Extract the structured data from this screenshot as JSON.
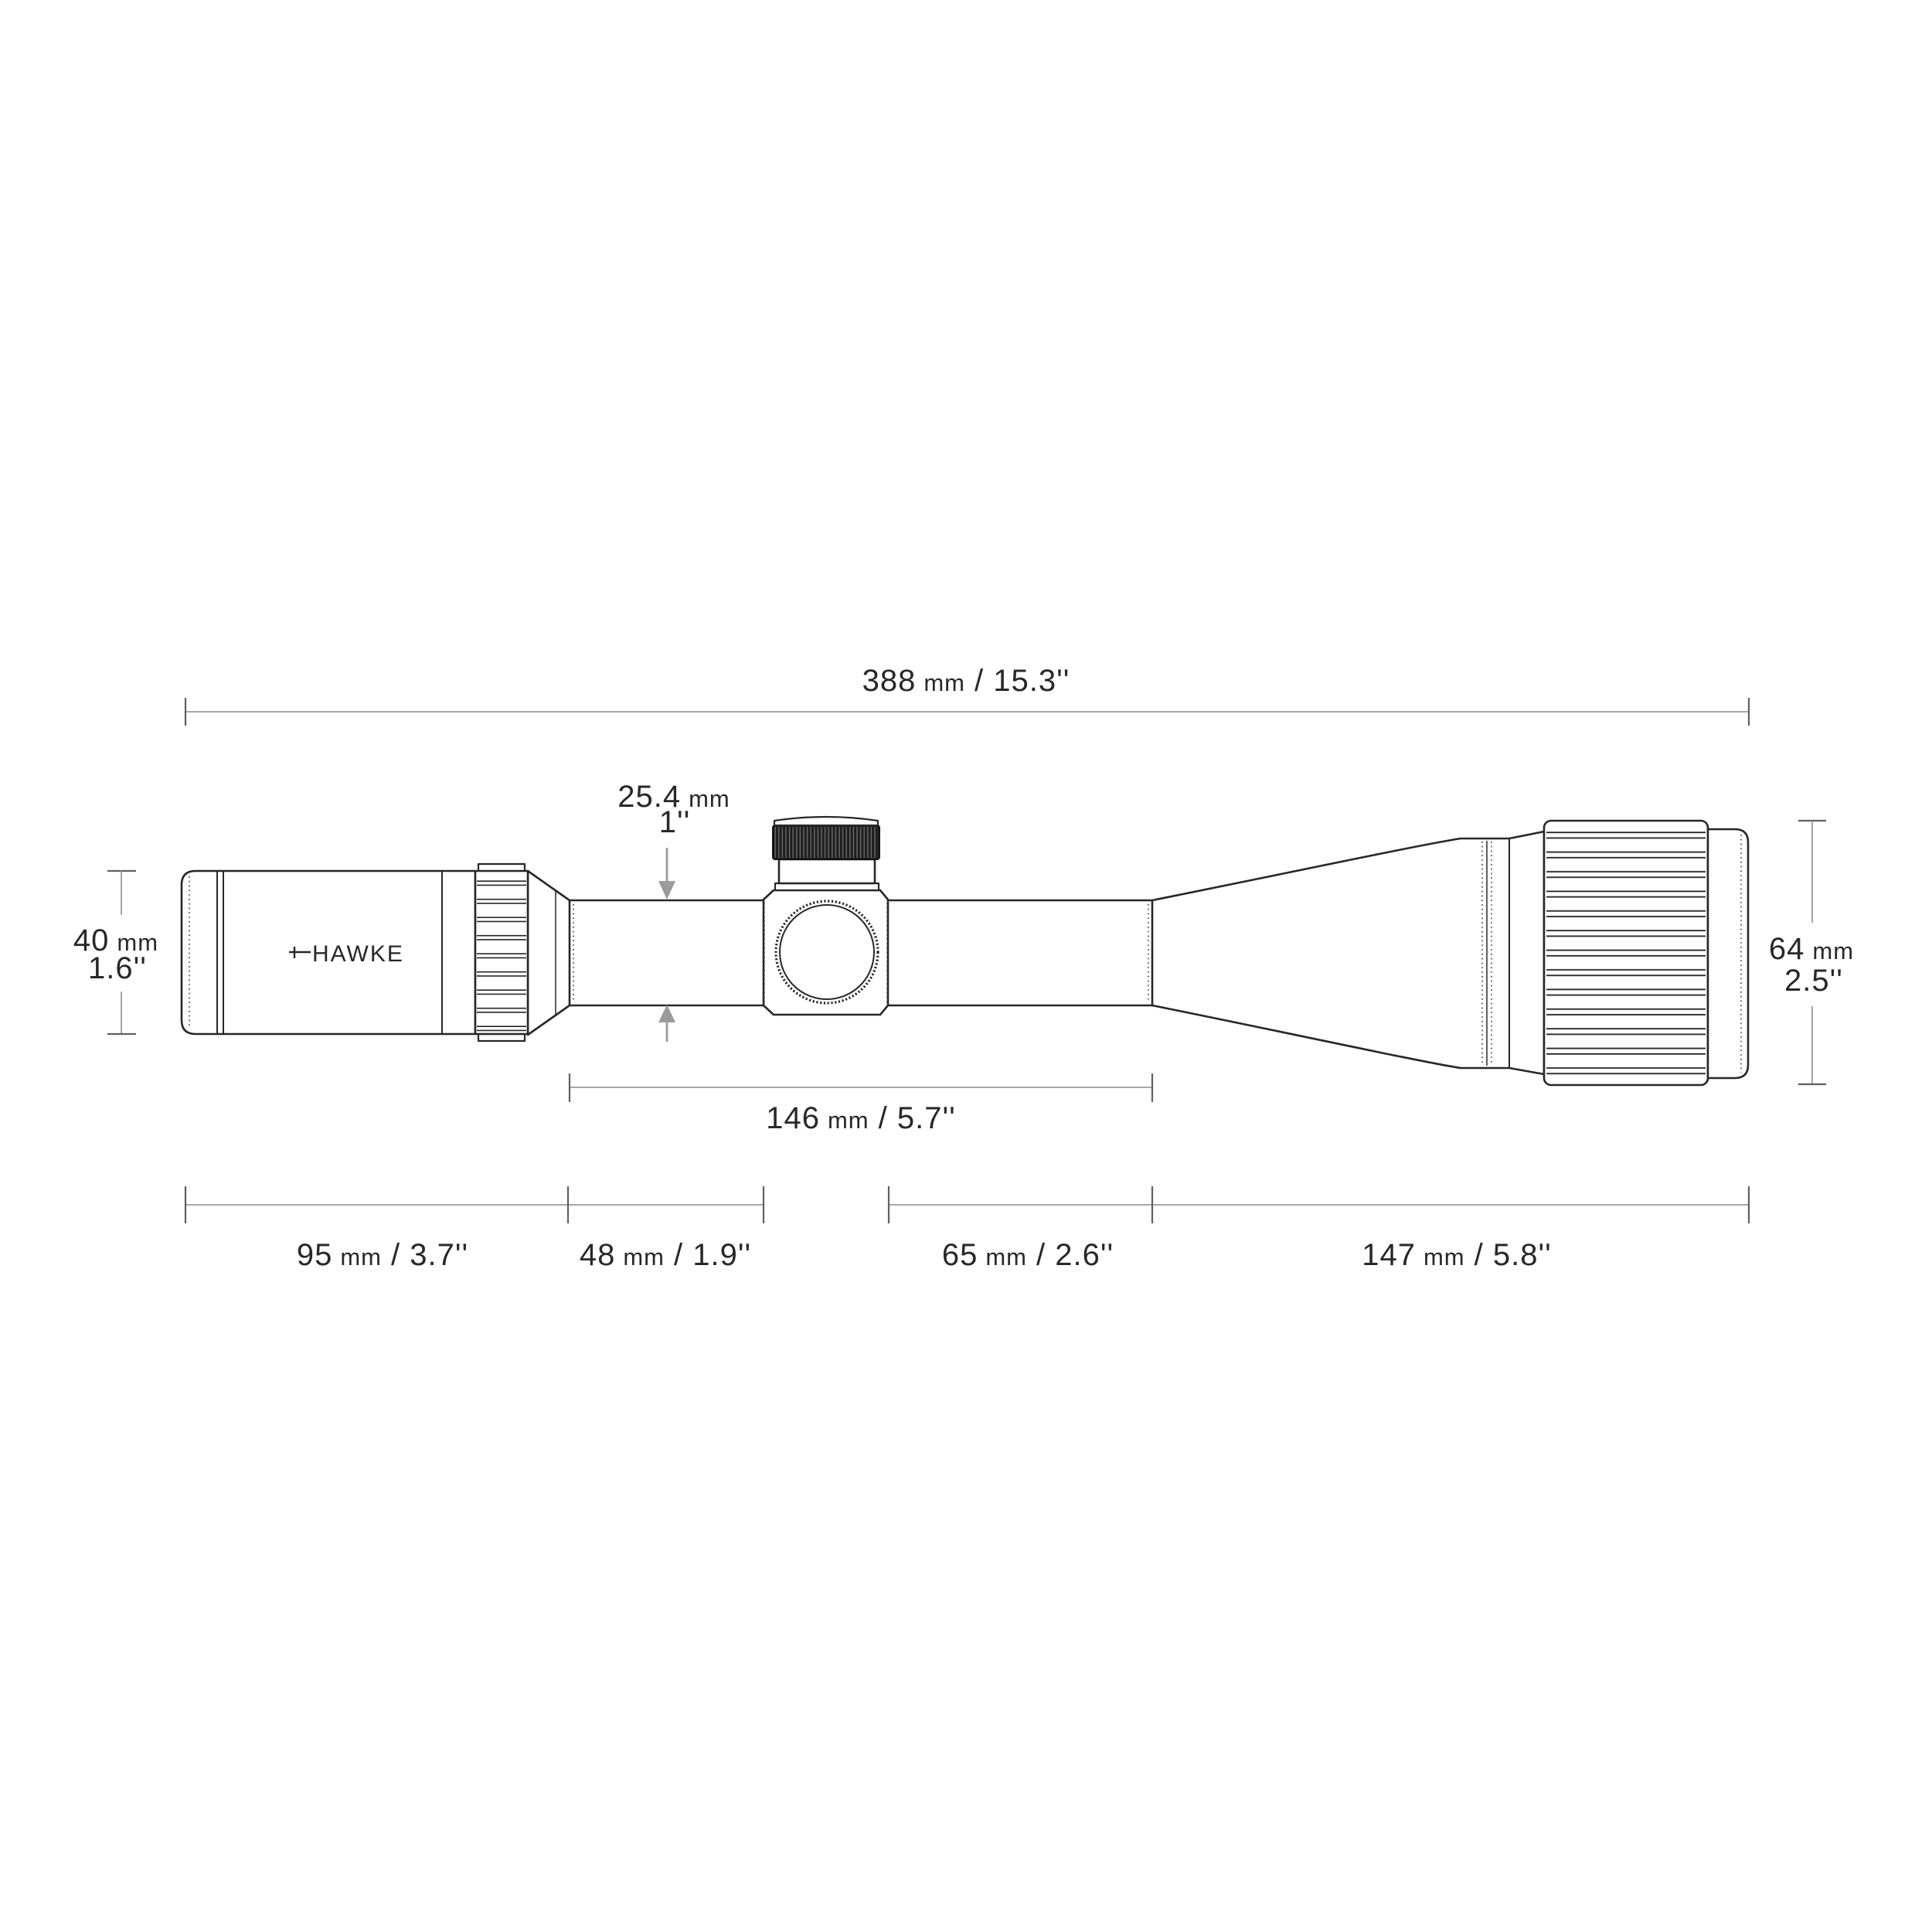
{
  "diagram": {
    "brand_logo": "HAWKE",
    "dims": {
      "overall": {
        "mm": "388",
        "unit": "mm",
        "inch": "/ 15.3''"
      },
      "tube": {
        "mm": "25.4",
        "unit": "mm",
        "inch": "1''"
      },
      "eyepiece": {
        "mm": "40",
        "unit": "mm",
        "inch": "1.6''"
      },
      "objective": {
        "mm": "64",
        "unit": "mm",
        "inch": "2.5''"
      },
      "mount": {
        "mm": "146",
        "unit": "mm",
        "inch": "/ 5.7''"
      },
      "seg_ocular": {
        "mm": "95",
        "unit": "mm",
        "inch": "/ 3.7''"
      },
      "seg_tube": {
        "mm": "48",
        "unit": "mm",
        "inch": "/ 1.9''"
      },
      "seg_mid": {
        "mm": "65",
        "unit": "mm",
        "inch": "/ 2.6''"
      },
      "seg_obj": {
        "mm": "147",
        "unit": "mm",
        "inch": "/ 5.8''"
      }
    }
  }
}
